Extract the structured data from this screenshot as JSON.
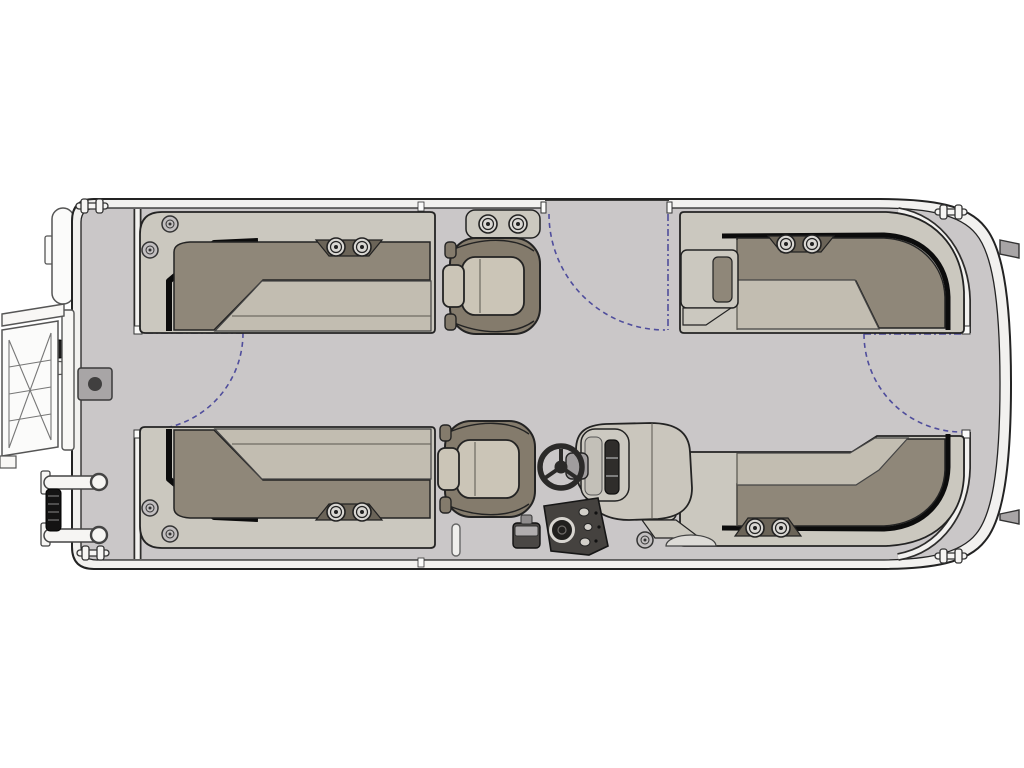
{
  "diagram": {
    "title": "Pontoon Boat Floor Plan — Top View",
    "description": "Overhead deck-layout line diagram of a pontoon boat, bow at left and stern at right",
    "view": "top-down"
  },
  "palette": {
    "background": "#ffffff",
    "outline": "#232323",
    "rail": "#f2f1ef",
    "deck": "#cac7c8",
    "seat_base": "#cbc8bf",
    "cushion_light": "#c2bdb1",
    "cushion_dark": "#8f8779",
    "shadow": "#0c0c0c",
    "chair_dark": "#847b6c",
    "chair_light": "#cbc5b7",
    "helm_panel": "#cac6bd",
    "console_dark": "#2f2d2b",
    "pod_dark": "#45423f",
    "white": "#fbfbfa",
    "hardware": "#a8a5a6",
    "speaker_plate": "#6b6458",
    "black": "#141313",
    "door_swing": "#4f4d9c"
  },
  "inventory": {
    "lounges": [
      {
        "id": "lounge-bow-top",
        "shape": "L",
        "position": "forward, top side"
      },
      {
        "id": "lounge-bow-bottom",
        "shape": "L",
        "position": "forward, bottom side"
      },
      {
        "id": "lounge-stern-top",
        "shape": "L",
        "position": "aft, top side, wraps stern corner"
      },
      {
        "id": "lounge-stern-bottom",
        "shape": "L",
        "position": "aft, bottom side, wraps stern corner"
      }
    ],
    "chairs": [
      {
        "id": "captain-chair-forward",
        "type": "swivel chair"
      },
      {
        "id": "captain-chair-helm",
        "type": "swivel chair"
      }
    ],
    "helm": {
      "steering_wheel": true,
      "windscreen_dash": true,
      "instrument_pod": {
        "gauge": 1,
        "switches": 3
      },
      "step_box": true
    },
    "gates": [
      {
        "id": "bow-gate",
        "location": "bow cross fence",
        "swing_arc": true
      },
      {
        "id": "mid-gate",
        "location": "top side rail",
        "swing_arc": true
      },
      {
        "id": "stern-gate",
        "location": "stern cross fence",
        "swing_arc": true
      }
    ],
    "speaker_pairs": 5,
    "cleats": 4,
    "deck_fittings": 5,
    "bow_equipment": [
      "folded boarding ladder",
      "grab rails with ribbed handle",
      "table pedestal base",
      "light base"
    ],
    "stern_equipment": [
      "stern platform",
      "motor mount tabs"
    ]
  }
}
